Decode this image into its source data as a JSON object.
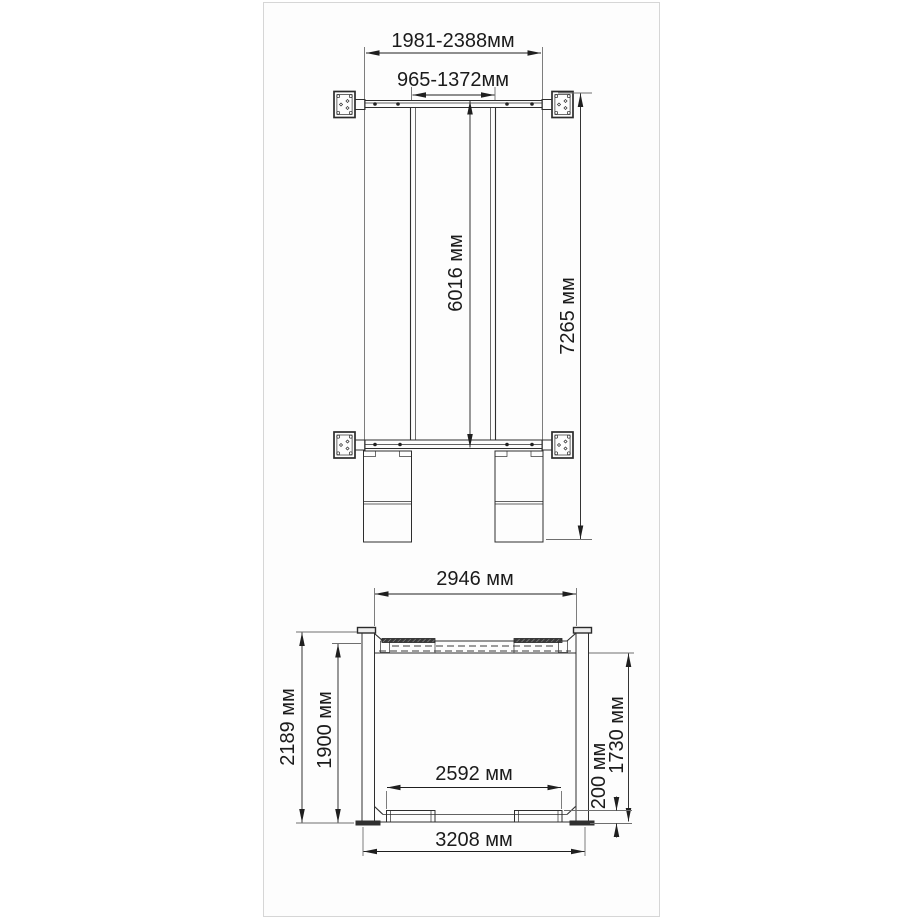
{
  "panel": {
    "background": "#fdfdfd",
    "border_color": "#d6d6d6"
  },
  "colors": {
    "structure_line": "#2e2e2e",
    "extension_line": "#6f6f6f",
    "dimension_line": "#1f1f1f",
    "text": "#1b1b1b",
    "dark_fill": "#2f2f2f"
  },
  "units": "мм",
  "top_view": {
    "outer_width": "1981-2388мм",
    "inner_width": "965-1372мм",
    "platform_length": "6016 мм",
    "total_length": "7265 мм"
  },
  "front_view": {
    "top_beam_span": "2946 мм",
    "overall_height": "2189 мм",
    "clear_height": "1900 мм",
    "pad_span": "2592 мм",
    "under_beam_height": "1730 мм",
    "pad_height": "200 мм",
    "base_width": "3208 мм"
  }
}
